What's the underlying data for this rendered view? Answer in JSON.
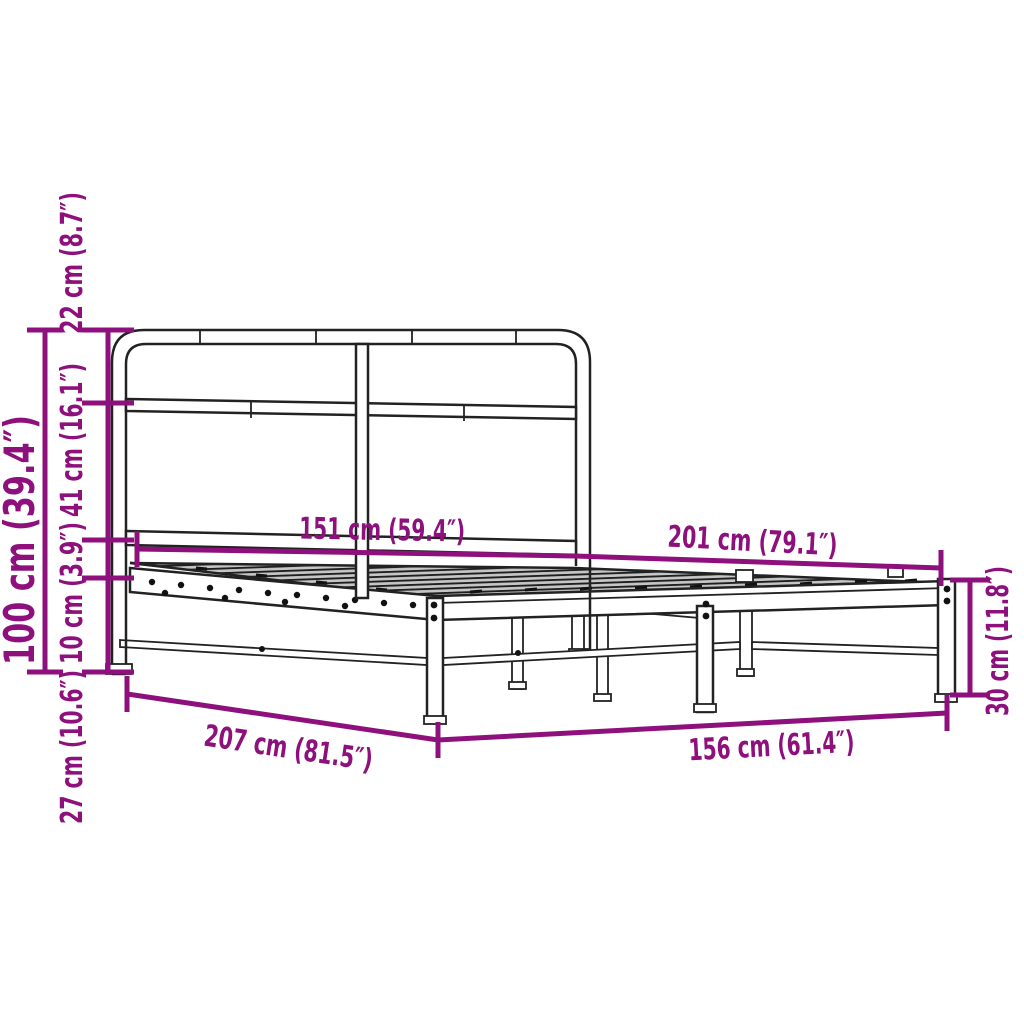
{
  "diagram": {
    "title": "Bed frame dimension diagram",
    "subject": "Metal bed frame with tubular headboard and slatted base",
    "style": {
      "dimension_color": "#8E107C",
      "outline_color": "#222222",
      "slat_fill": "#c6c6c6",
      "background": "#ffffff"
    },
    "dimensions": {
      "headboard_top_section": "22 cm (8.7″)",
      "headboard_middle_section": "41 cm (16.1″)",
      "frame_side_height": "10 cm (3.9″)",
      "under_bed_clearance": "27 cm (10.6″)",
      "total_height": "100 cm (39.4″)",
      "headboard_width": "151 cm (59.4″)",
      "frame_length_inner": "201 cm (79.1″)",
      "frame_length_total": "207 cm (81.5″)",
      "frame_width_total": "156 cm (61.4″)",
      "foot_end_height": "30 cm (11.8″)"
    }
  }
}
